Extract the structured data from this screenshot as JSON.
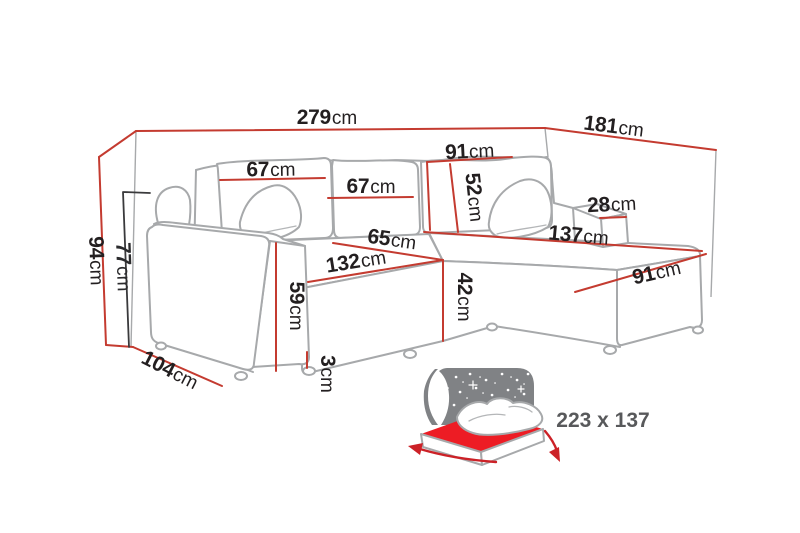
{
  "palette": {
    "dimension_red": "#c43b30",
    "dark_line": "#3a3a3c",
    "sofa_outline_gray": "#a7a9ab",
    "label_text": "#231f20",
    "sleeping_text_gray": "#58595b",
    "star_panel_gray": "#808285",
    "mattress_red": "#ed1c24",
    "background": "#ffffff"
  },
  "dimensions": {
    "total_width": {
      "value": "279",
      "unit": "cm"
    },
    "total_depth": {
      "value": "181",
      "unit": "cm"
    },
    "corner_backrest_width": {
      "value": "91",
      "unit": "cm"
    },
    "back_cushion_left": {
      "value": "67",
      "unit": "cm"
    },
    "back_cushion_middle": {
      "value": "67",
      "unit": "cm"
    },
    "back_cushion_height": {
      "value": "52",
      "unit": "cm"
    },
    "side_armrest_width": {
      "value": "28",
      "unit": "cm"
    },
    "chaise_length": {
      "value": "137",
      "unit": "cm"
    },
    "chaise_width": {
      "value": "91",
      "unit": "cm"
    },
    "seat_depth": {
      "value": "65",
      "unit": "cm"
    },
    "seat_width": {
      "value": "132",
      "unit": "cm"
    },
    "seat_height": {
      "value": "42",
      "unit": "cm"
    },
    "armrest_height": {
      "value": "59",
      "unit": "cm"
    },
    "leg_height": {
      "value": "3",
      "unit": "cm"
    },
    "armrest_depth": {
      "value": "104",
      "unit": "cm"
    },
    "total_height": {
      "value": "94",
      "unit": "cm"
    },
    "backrest_height": {
      "value": "77",
      "unit": "cm"
    }
  },
  "sleeping_area": {
    "label": "223 x 137",
    "icon": "bed-moon-stars-icon"
  }
}
